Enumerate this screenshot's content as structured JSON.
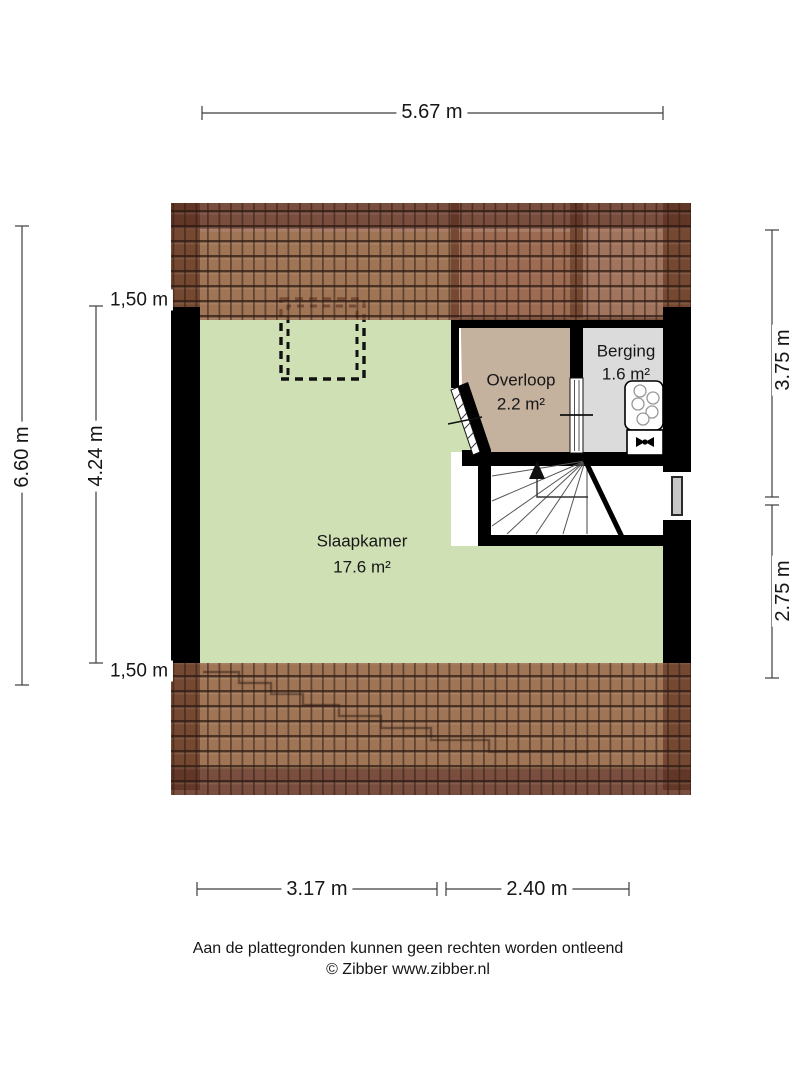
{
  "floor_plan": {
    "rooms": [
      {
        "name": "Slaapkamer",
        "area": "17.6 m²",
        "floor_color": "#cfe0b5"
      },
      {
        "name": "Overloop",
        "area": "2.2 m²",
        "floor_color": "#c4b19e"
      },
      {
        "name": "Berging",
        "area": "1.6 m²",
        "floor_color": "#dbdbdb"
      }
    ],
    "features": [
      "roof-tiles-top",
      "roof-tiles-bottom",
      "dormer-dashed-outline",
      "stairs-with-up-arrow",
      "window-right-wall",
      "boiler-unit",
      "valve-unit"
    ]
  },
  "dimensions": {
    "top": "5.67 m",
    "left_outer": "6.60 m",
    "left_roof_top": "1,50 m",
    "left_room": "4.24 m",
    "left_roof_bottom": "1,50 m",
    "right_upper": "3.75 m",
    "right_lower": "2.75 m",
    "bottom_left": "3.17 m",
    "bottom_right": "2.40 m"
  },
  "footer": {
    "disclaimer": "Aan de plattegronden kunnen geen rechten worden ontleend",
    "copyright": "© Zibber www.zibber.nl"
  },
  "colors": {
    "wall": "#000000",
    "roof_mid": "#925A3E",
    "roof_dark": "#542C22",
    "slaapkamer_floor": "#cfe0b5",
    "overloop_floor": "#c4b19e",
    "berging_floor": "#dbdbdb",
    "dimension_lines": "#3c3c3c",
    "text": "#161616"
  }
}
